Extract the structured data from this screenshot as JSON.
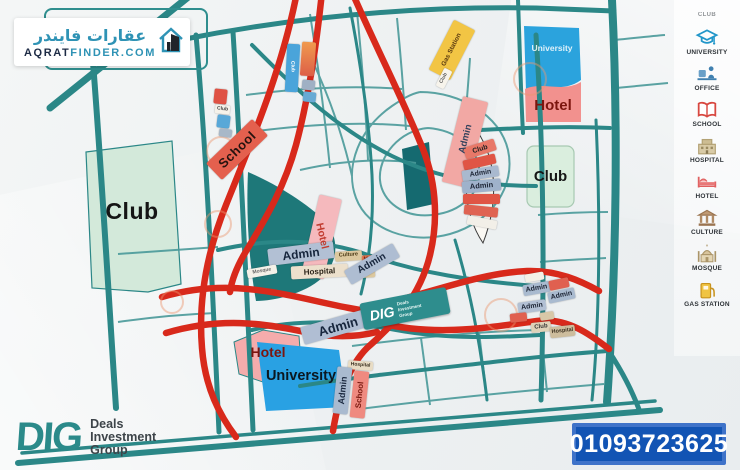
{
  "brand": {
    "name_ar": "عقارات فايندر",
    "domain_left": "AQRAT",
    "domain_right": "FINDER.COM"
  },
  "legend": {
    "partial_top_label": "CLUB",
    "items": [
      {
        "label": "UNIVERSITY",
        "icon": "graduation-cap",
        "color": "#2196c9"
      },
      {
        "label": "OFFICE",
        "icon": "office-desk",
        "color": "#4080b0"
      },
      {
        "label": "SCHOOL",
        "icon": "open-book",
        "color": "#d84840"
      },
      {
        "label": "HOSPITAL",
        "icon": "hospital-building",
        "color": "#c9b284"
      },
      {
        "label": "HOTEL",
        "icon": "bed",
        "color": "#e87878"
      },
      {
        "label": "CULTURE",
        "icon": "pillared-building",
        "color": "#b08a64"
      },
      {
        "label": "MOSQUE",
        "icon": "mosque-dome",
        "color": "#c9b28e"
      },
      {
        "label": "GAS STATION",
        "icon": "fuel-pump",
        "color": "#f0c443"
      }
    ]
  },
  "map": {
    "labels": {
      "club_left": "Club",
      "school_main": "School",
      "club_tiny_left": "Club",
      "club_tiny_top": "Club",
      "gas_station": "Gas Station",
      "club_tiny_gas": "Club",
      "admin_gas": "Admin",
      "university_top": "University",
      "hotel_top": "Hotel",
      "club_right": "Club",
      "club_lens": "Club",
      "admin_lens_1": "Admin",
      "admin_lens_2": "Admin",
      "hotel_road": "Hotel",
      "admin_center": "Admin",
      "culture_a": "Culture",
      "mosque_a": "Mosque",
      "hospital_center": "Hospital",
      "mosque_b": "Mosque",
      "culture_b": "Culture",
      "admin_diag_1": "Admin",
      "admin_diag_2": "Admin",
      "hotel_bottom": "Hotel",
      "university_bottom": "University",
      "hospital_bottom": "Hospital",
      "admin_bottom": "Admin",
      "school_bottom": "School",
      "admin_right_1": "Admin",
      "admin_right_2": "Admin",
      "admin_right_3": "Admin",
      "club_right_small": "Club",
      "hospital_right": "Hospital"
    }
  },
  "watermark": {
    "abbr": "DIG",
    "line1": "Deals",
    "line2": "Investment",
    "line3": "Group"
  },
  "footer": {
    "logo_abbr": "DIG",
    "company_line1": "Deals",
    "company_line2": "Investment",
    "company_line3": "Group",
    "phone": "01093723625"
  },
  "colors": {
    "road_teal": "#2b8787",
    "road_red": "#d8291b",
    "park_green": "#1e7879",
    "club_mint": "#d3e9da",
    "university_blue": "#2aa2e2",
    "hotel_pink": "#f2918e",
    "admin_gray_blue": "#aebdd2",
    "phone_box_blue": "#1254b4"
  }
}
